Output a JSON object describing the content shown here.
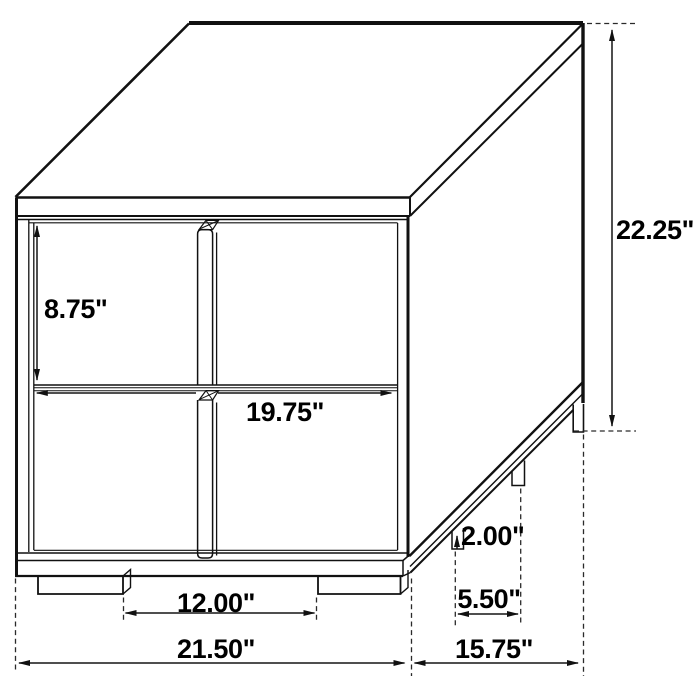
{
  "diagram": {
    "subject": "Two-drawer nightstand isometric dimension line drawing",
    "units": "inches",
    "colors": {
      "line": "#111111",
      "background": "#ffffff",
      "text": "#000000"
    },
    "dimensions": {
      "overall_height": "22.25\"",
      "overall_width": "21.50\"",
      "overall_depth": "15.75\"",
      "drawer_height": "8.75\"",
      "drawer_width": "19.75\"",
      "front_feet_spacing": "12.00\"",
      "side_feet_spacing": "5.50\"",
      "foot_height": "2.00\""
    }
  }
}
